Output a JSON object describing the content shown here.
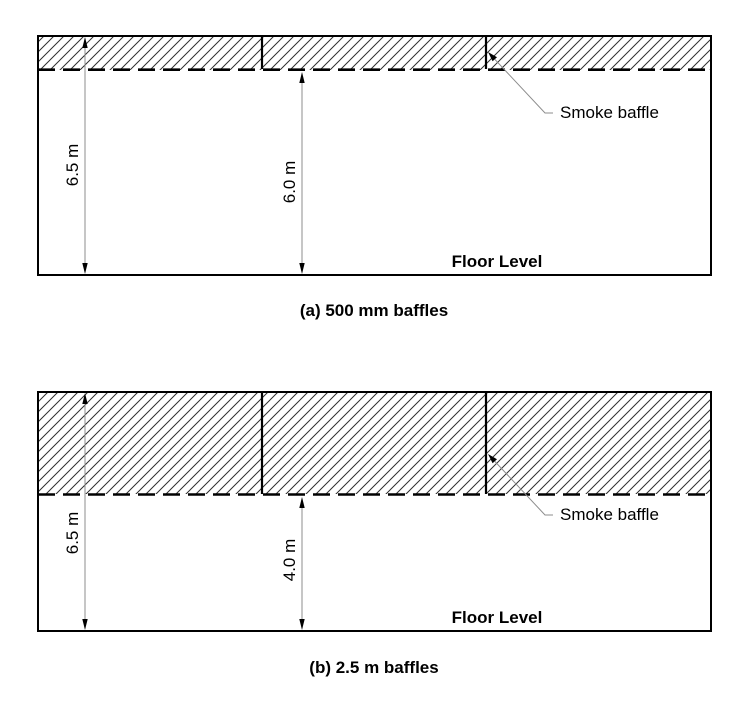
{
  "figure": {
    "diagrams": [
      {
        "id": "a",
        "caption": "(a) 500 mm baffles",
        "overall_height_label": "6.5 m",
        "clear_height_label": "6.0 m",
        "floor_label": "Floor Level",
        "baffle_label": "Smoke baffle"
      },
      {
        "id": "b",
        "caption": "(b) 2.5 m baffles",
        "overall_height_label": "6.5 m",
        "clear_height_label": "4.0 m",
        "floor_label": "Floor Level",
        "baffle_label": "Smoke baffle"
      }
    ],
    "colors": {
      "outline": "#000000",
      "dimension_line": "#8c8c8c",
      "hatch_line": "#303030",
      "text": "#000000",
      "background": "#ffffff"
    }
  }
}
